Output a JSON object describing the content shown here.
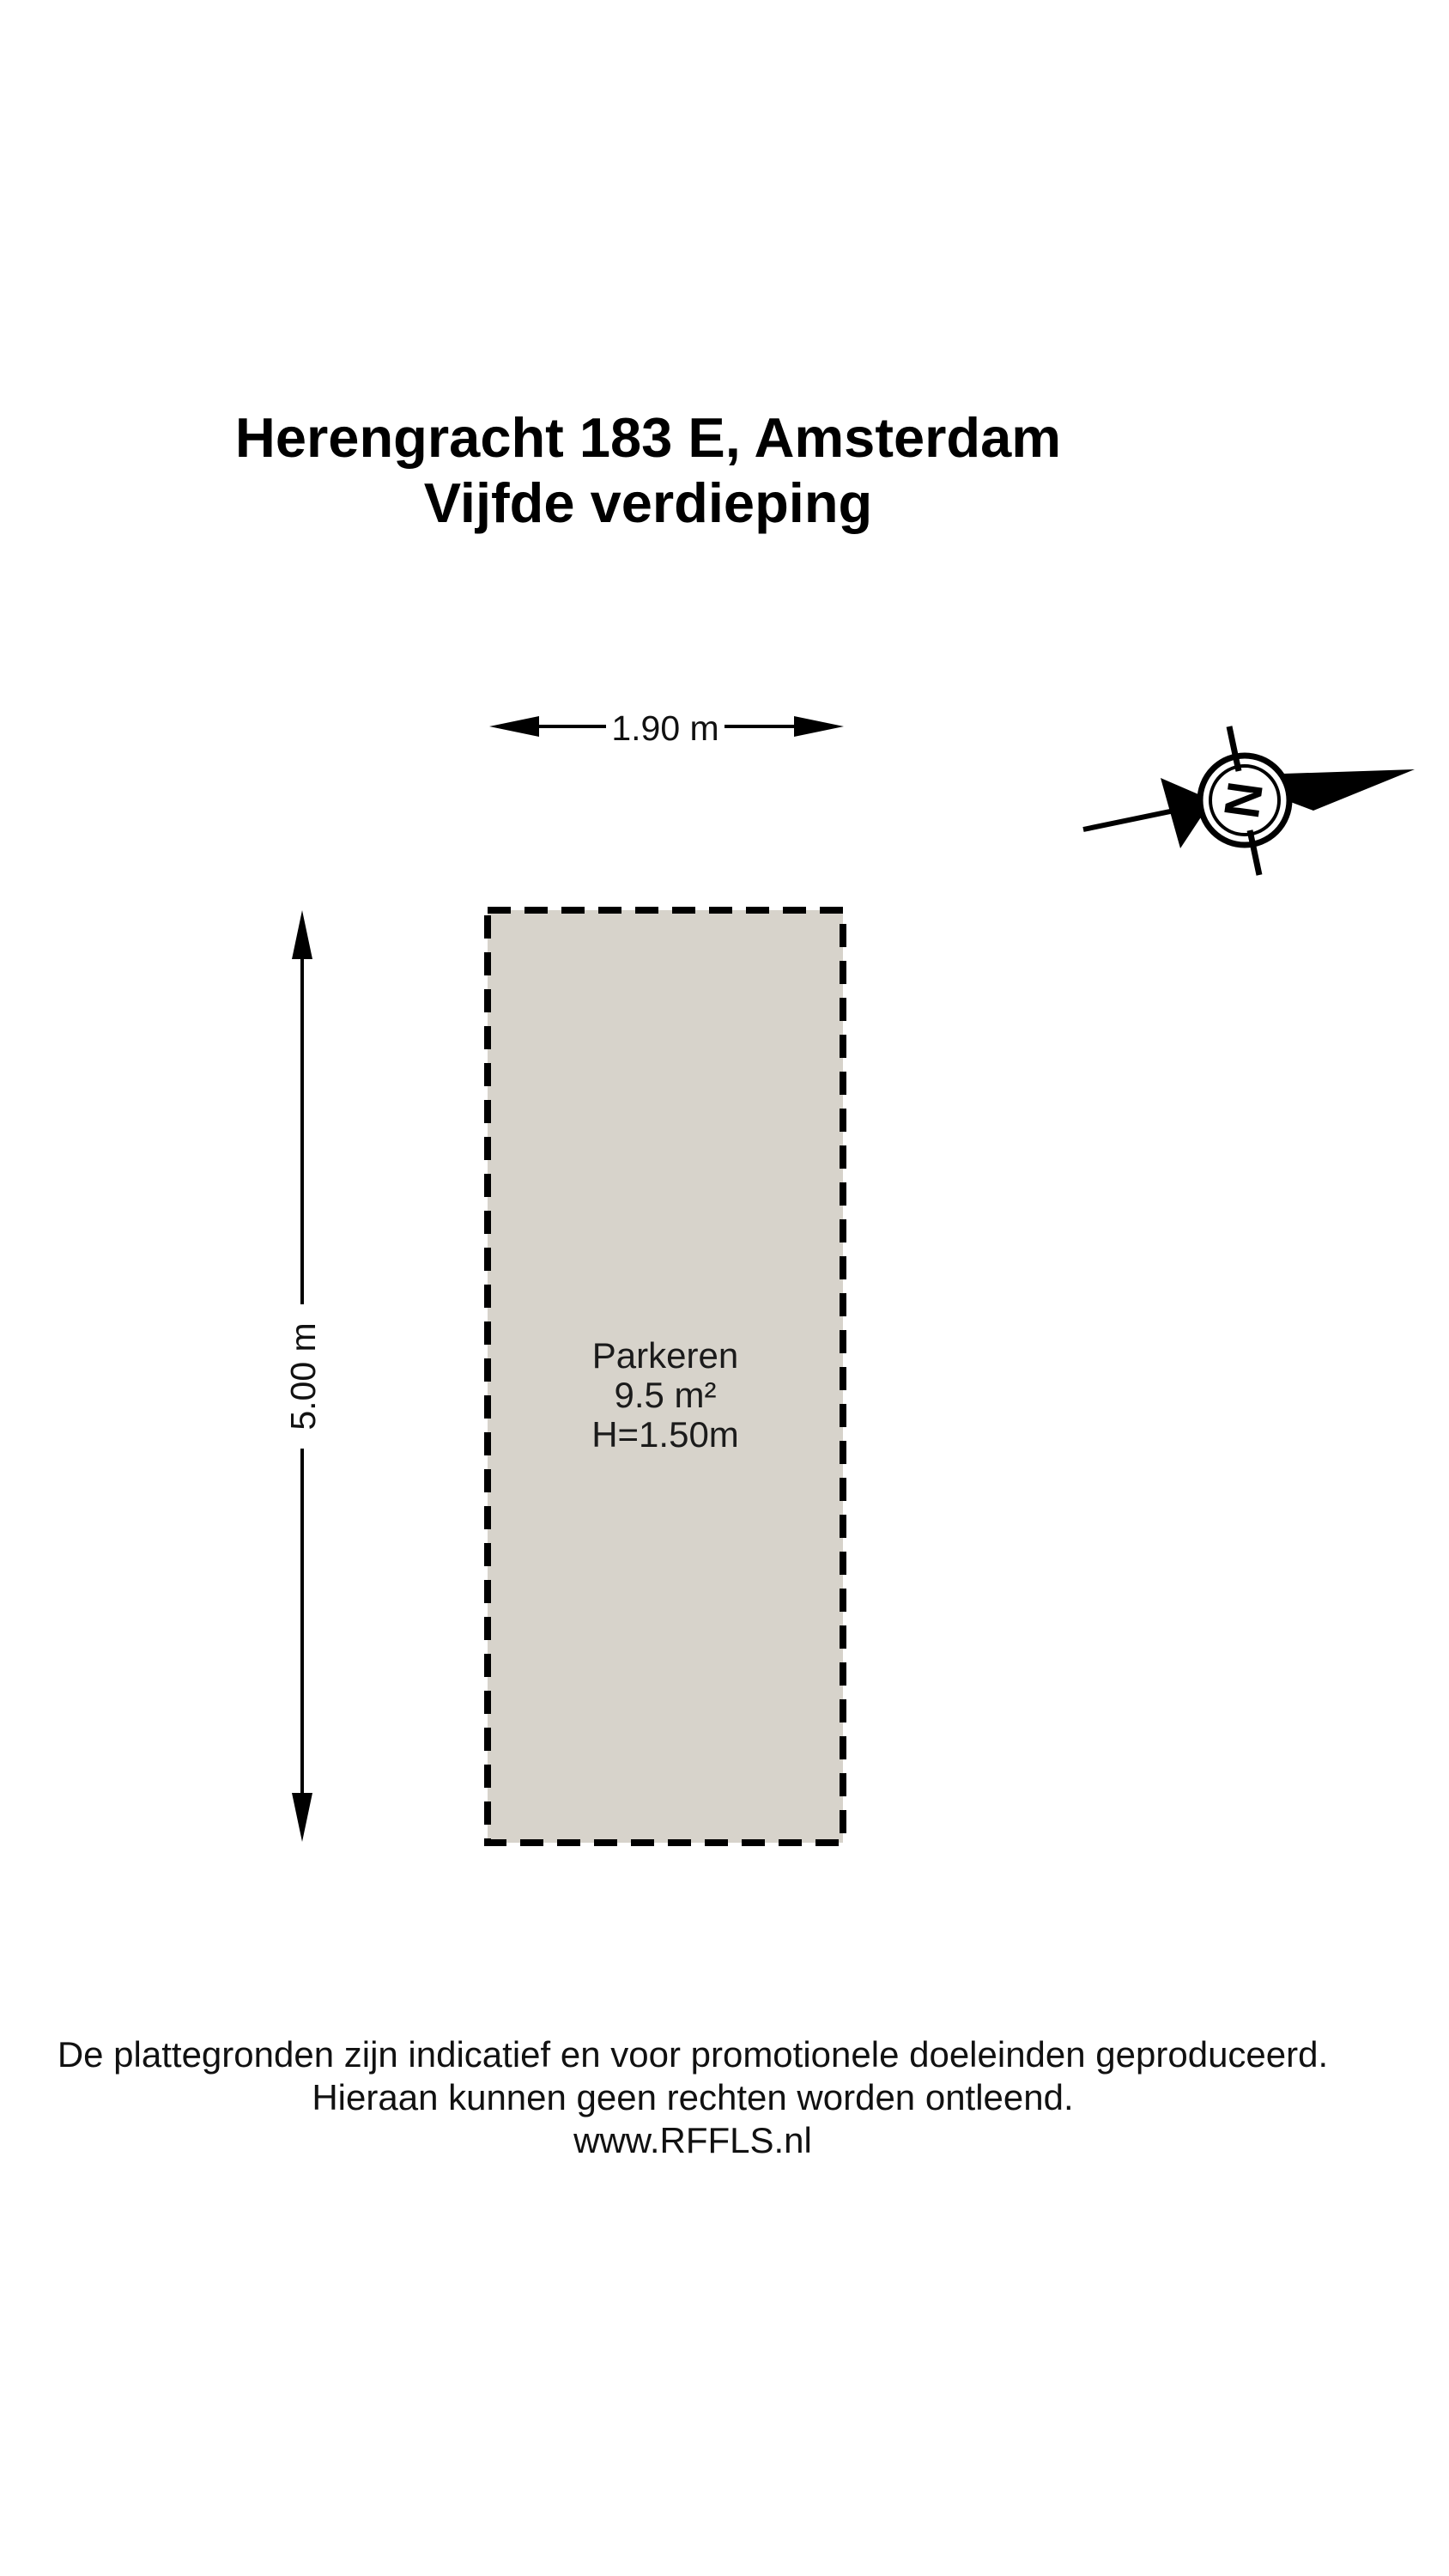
{
  "title": {
    "line1": "Herengracht 183 E, Amsterdam",
    "line2": "Vijfde verdieping"
  },
  "floorplan": {
    "room": {
      "name": "Parkeren",
      "area": "9.5 m²",
      "ceiling_height": "H=1.50m"
    },
    "dimensions": {
      "width_label": "1.90 m",
      "depth_label": "5.00 m"
    },
    "compass": {
      "letter": "N"
    },
    "colors": {
      "room_fill": "#d7d3cb",
      "line": "#000000"
    }
  },
  "footer": {
    "line1": "De plattegronden zijn indicatief en voor promotionele doeleinden geproduceerd.",
    "line2": "Hieraan kunnen geen rechten worden ontleend.",
    "line3": "www.RFFLS.nl"
  }
}
